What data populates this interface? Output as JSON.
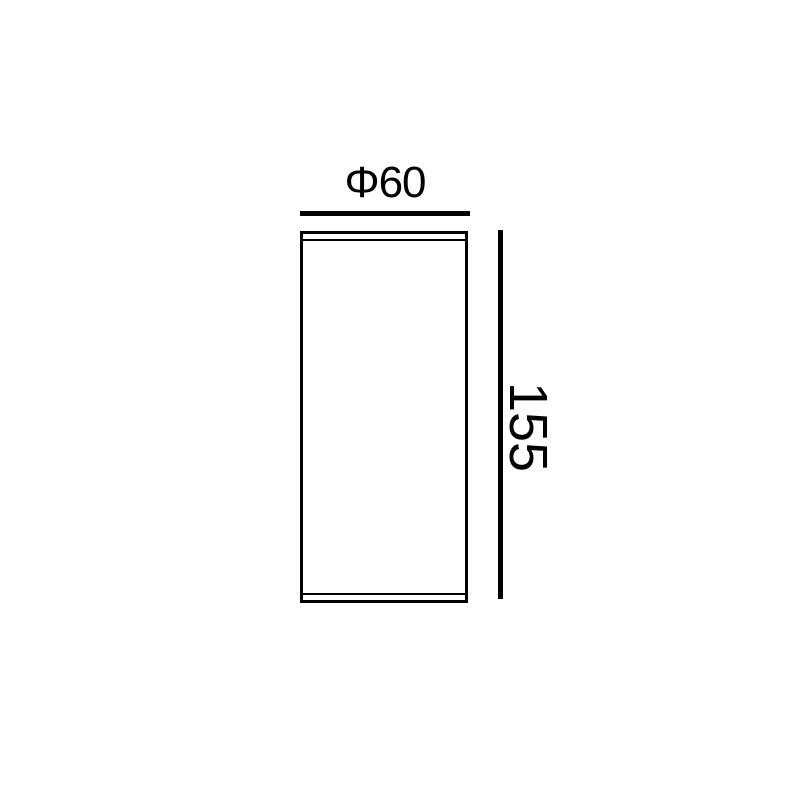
{
  "drawing": {
    "title": "cylinder dimension drawing",
    "background_color": "#ffffff",
    "line_color": "#000000",
    "dimensions": {
      "diameter": {
        "label": "Φ60",
        "value": 60
      },
      "height": {
        "label": "155",
        "value": 155
      }
    }
  }
}
